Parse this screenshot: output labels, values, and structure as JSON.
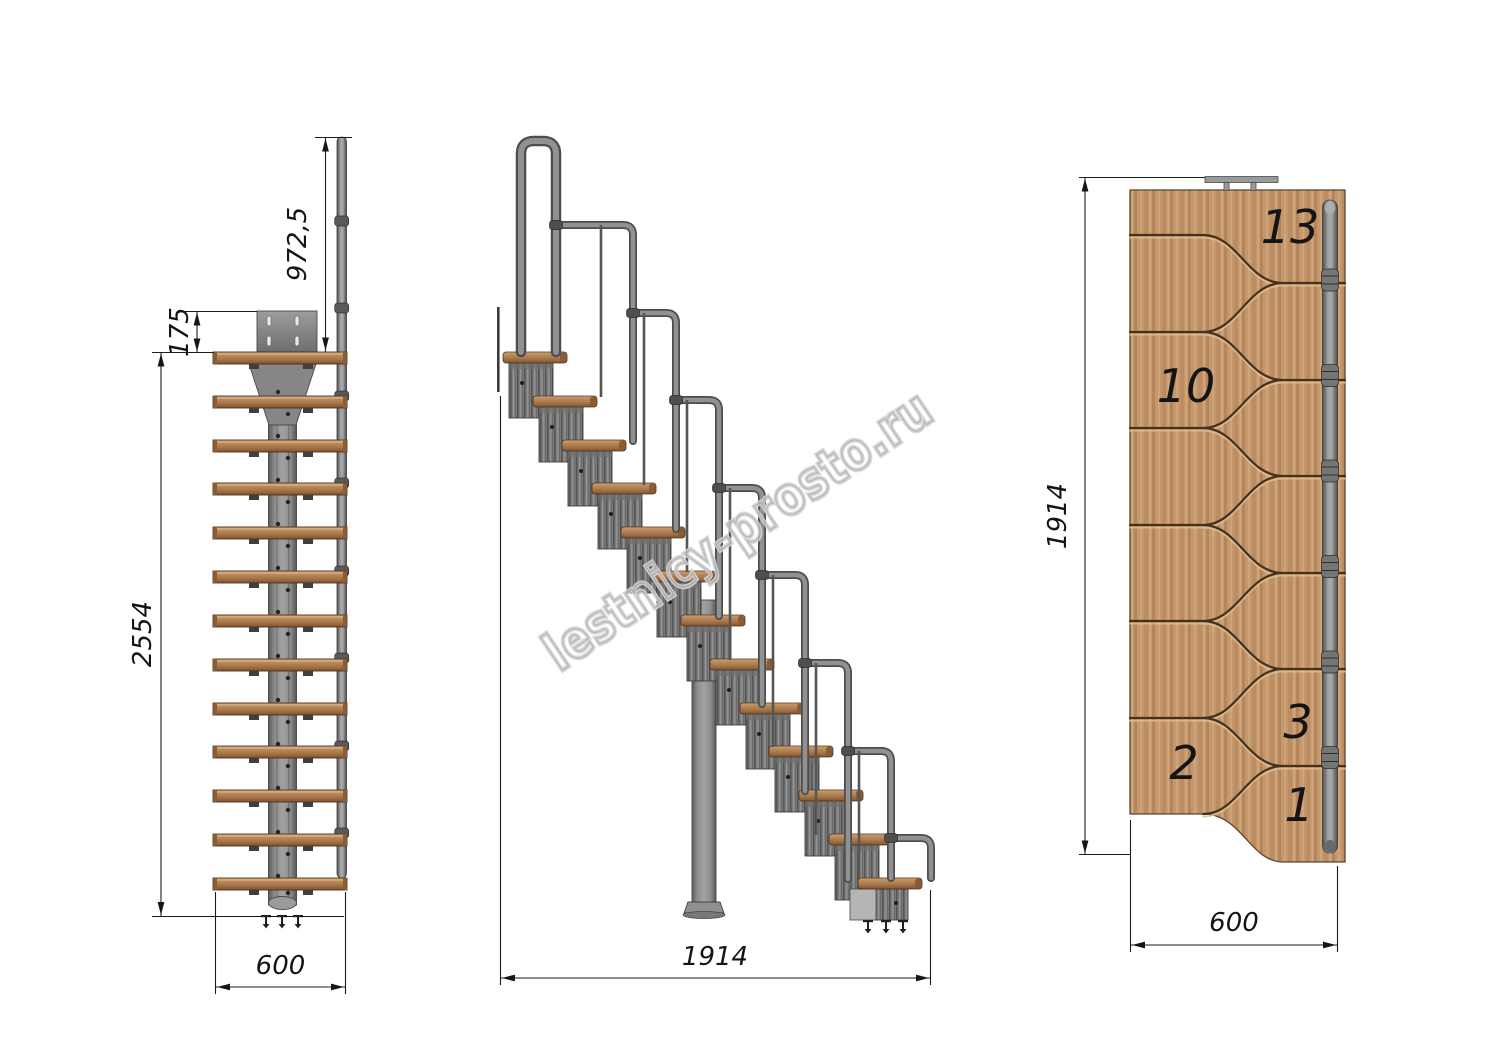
{
  "watermark": {
    "text": "lestnicy-prosto.ru"
  },
  "front_view": {
    "steps_count": "13",
    "dims": {
      "rail_height": "972,5",
      "top_module_height": "175",
      "total_height": "2554",
      "width": "600"
    }
  },
  "side_view": {
    "dims": {
      "length": "1914"
    }
  },
  "plan_view": {
    "dims": {
      "length": "1914",
      "width": "600"
    },
    "step_numbers": {
      "n13": "13",
      "n10": "10",
      "n3": "3",
      "n2": "2",
      "n1": "1"
    }
  },
  "colors": {
    "wood": "#c5976d",
    "wood_dark": "#7c4e2c",
    "metal": "#8c8c8c",
    "metal_dark": "#4d4d4d",
    "groove": "#43321f",
    "dimension_line": "#1c1c1c",
    "watermark": "#c4c4c4",
    "background": "#ffffff"
  }
}
